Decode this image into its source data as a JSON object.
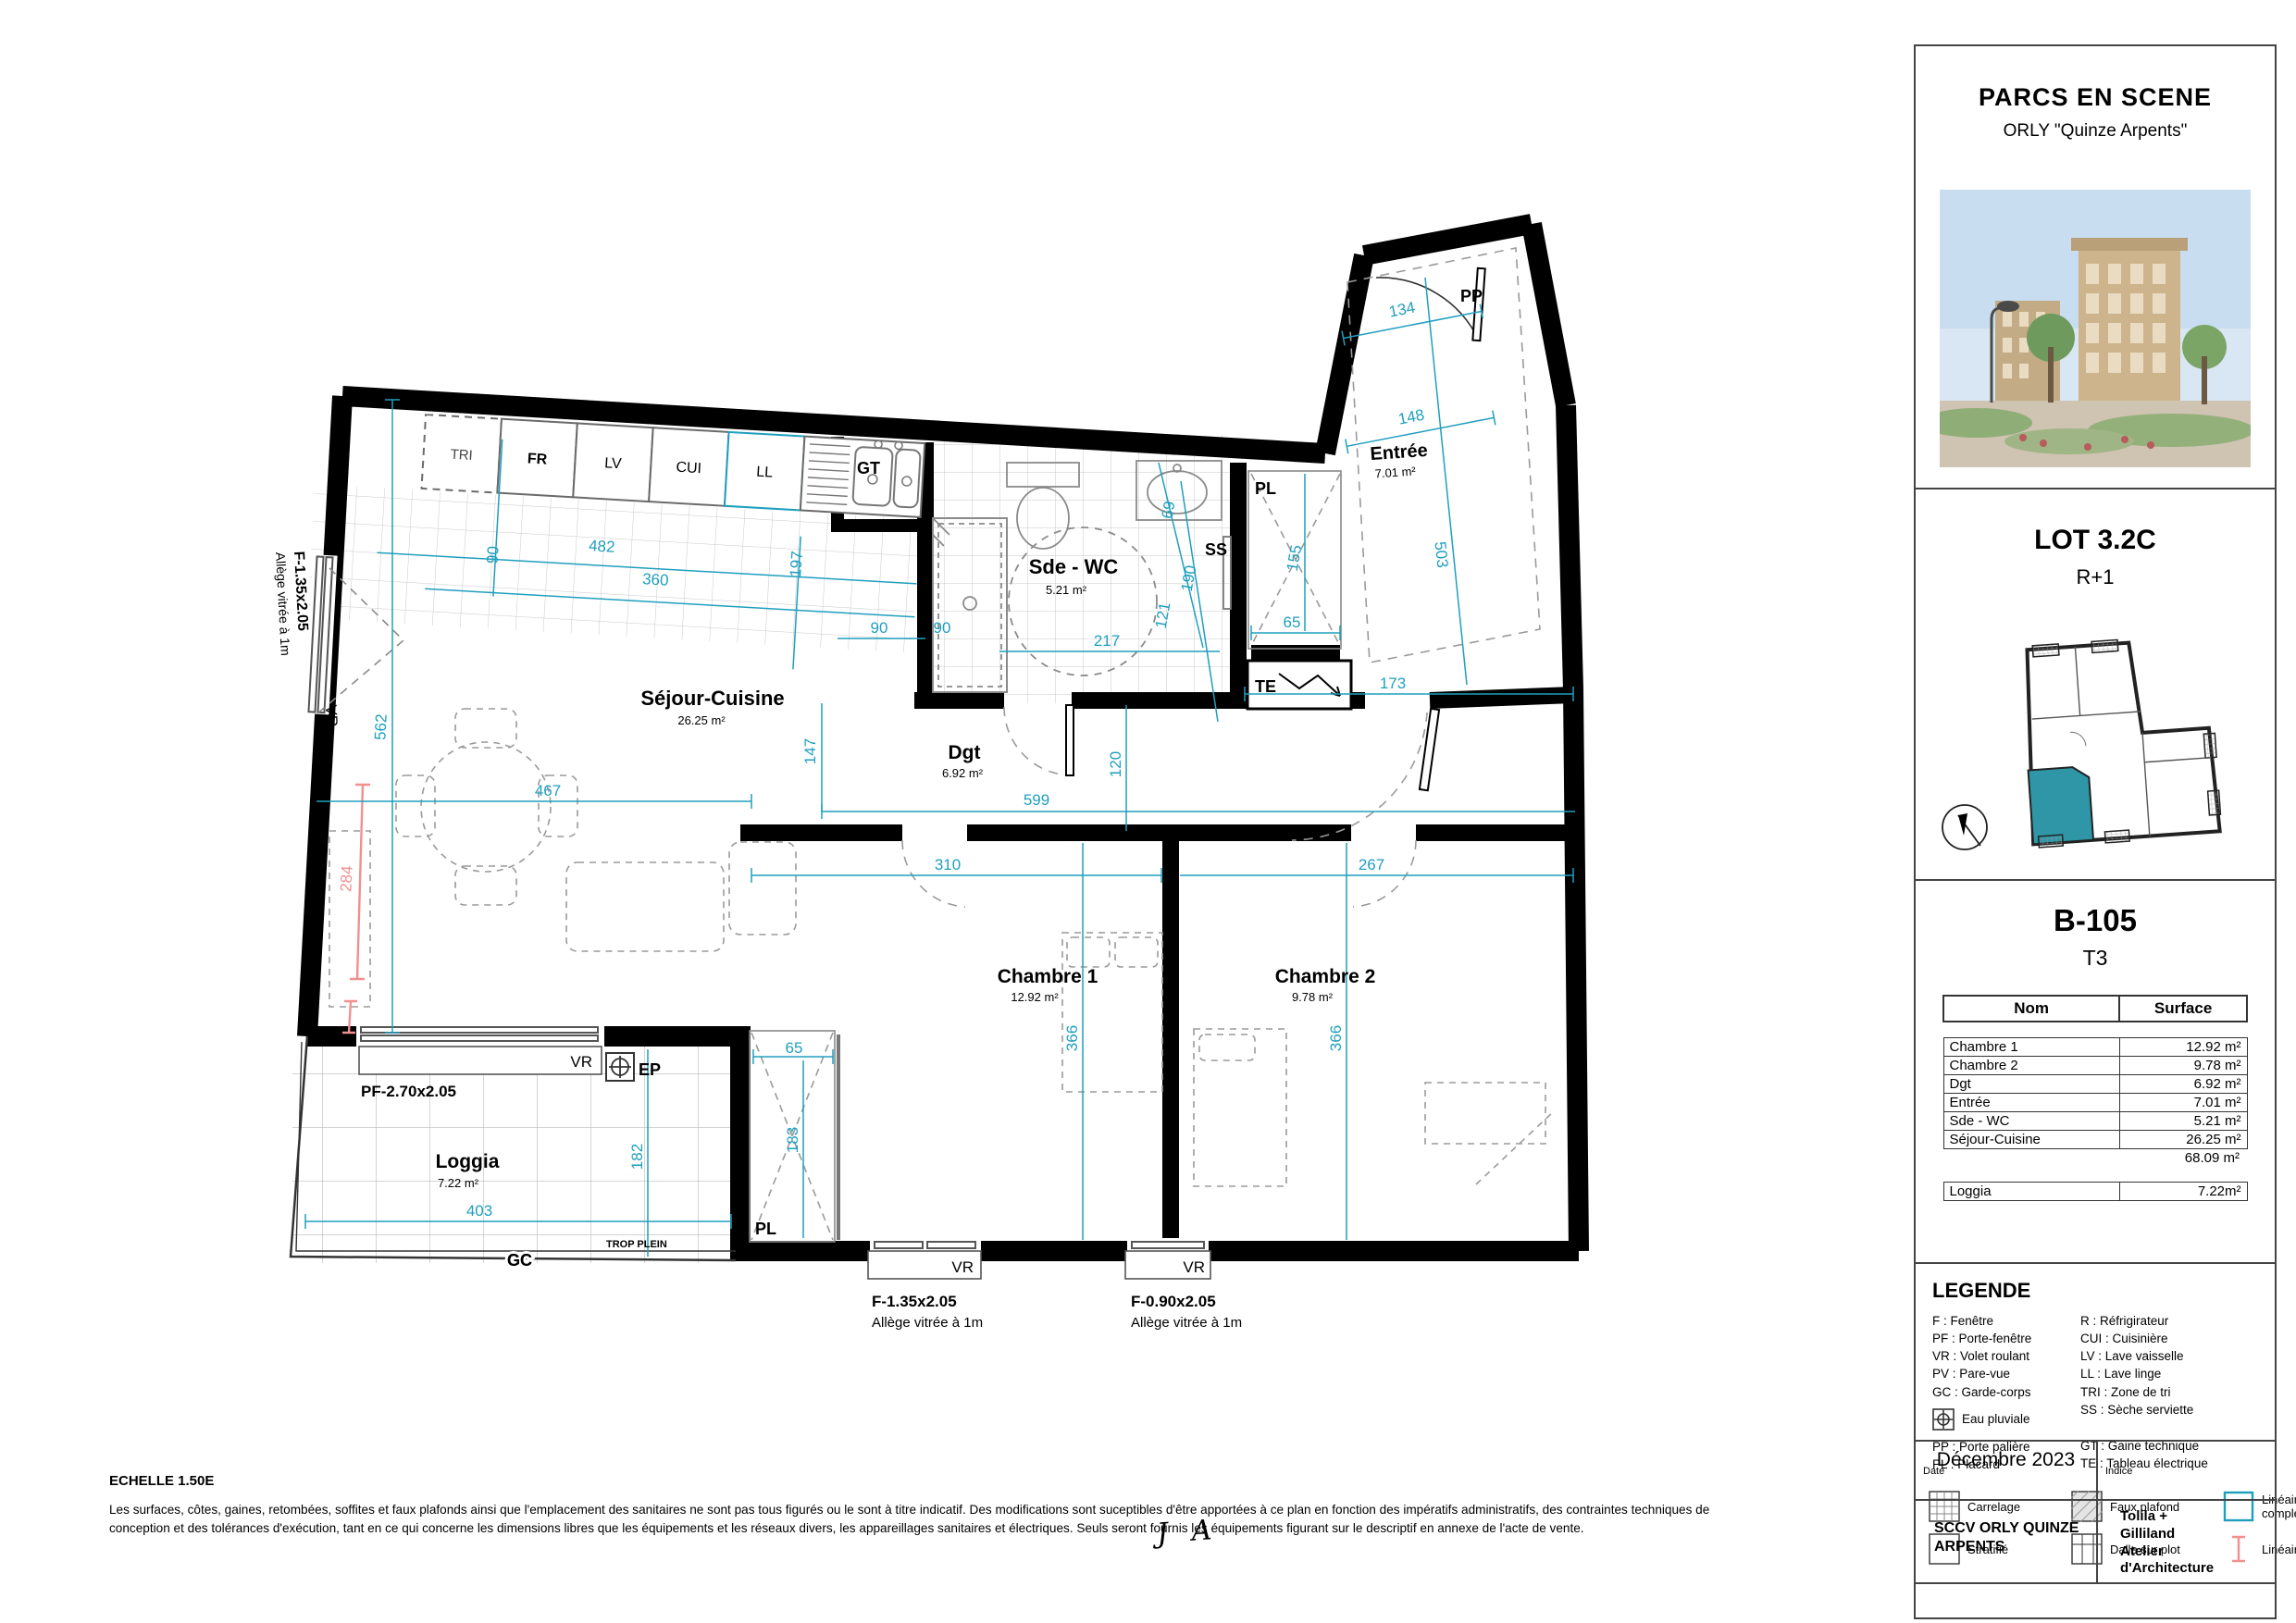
{
  "plan": {
    "rooms": {
      "entree": {
        "name": "Entrée",
        "area": "7.01 m²"
      },
      "sde": {
        "name": "Sde - WC",
        "area": "5.21 m²"
      },
      "sejour": {
        "name": "Séjour-Cuisine",
        "area": "26.25 m²"
      },
      "dgt": {
        "name": "Dgt",
        "area": "6.92 m²"
      },
      "ch1": {
        "name": "Chambre 1",
        "area": "12.92 m²"
      },
      "ch2": {
        "name": "Chambre 2",
        "area": "9.78 m²"
      },
      "loggia": {
        "name": "Loggia",
        "area": "7.22 m²"
      }
    },
    "dims": [
      "134",
      "148",
      "503",
      "173",
      "120",
      "599",
      "147",
      "90",
      "482",
      "360",
      "197",
      "90",
      "69",
      "190",
      "121",
      "217",
      "90",
      "65",
      "155",
      "310",
      "267",
      "366",
      "366",
      "65",
      "183",
      "182",
      "403",
      "562",
      "467",
      "284"
    ],
    "tags": {
      "pp": "PP",
      "gt": "GT",
      "ss": "SS",
      "pl": "PL",
      "te": "TE",
      "vr": "VR",
      "ep": "EP",
      "gc": "GC",
      "trop": "TROP PLEIN",
      "pf": "PF-2.70x2.05",
      "f135": "F-1.35x2.05",
      "f090": "F-0.90x2.05",
      "allege": "Allège vitrée à 1m"
    },
    "appliances": [
      "TRI",
      "FR",
      "LV",
      "CUI",
      "LL"
    ],
    "colors": {
      "dim": "#1f9fbe",
      "red": "#f28f8f",
      "unit_fill": "#2e96a6"
    }
  },
  "panel": {
    "project_title": "PARCS EN SCENE",
    "project_subtitle": "ORLY \"Quinze Arpents\"",
    "lot_title": "LOT 3.2C",
    "lot_level": "R+1",
    "unit_id": "B-105",
    "unit_type": "T3",
    "table": {
      "headers": [
        "Nom",
        "Surface"
      ],
      "rows": [
        [
          "Chambre 1",
          "12.92 m²"
        ],
        [
          "Chambre 2",
          "9.78 m²"
        ],
        [
          "Dgt",
          "6.92 m²"
        ],
        [
          "Entrée",
          "7.01 m²"
        ],
        [
          "Sde - WC",
          "5.21 m²"
        ],
        [
          "Séjour-Cuisine",
          "26.25 m²"
        ]
      ],
      "total": "68.09 m²",
      "loggia_row": [
        "Loggia",
        "7.22m²"
      ]
    },
    "legend": {
      "title": "LEGENDE",
      "col1": [
        "F : Fenêtre",
        "PF : Porte-fenêtre",
        "VR : Volet roulant",
        "PV : Pare-vue",
        "GC : Garde-corps"
      ],
      "eau_pluviale": "Eau pluviale",
      "col1b": [
        "PP : Porte palière",
        "PL : Placard"
      ],
      "col2": [
        "R : Réfrigirateur",
        "CUI : Cuisinière",
        "LV : Lave vaisselle",
        "LL : Lave linge",
        "TRI : Zone de tri",
        "SS : Sèche serviette"
      ],
      "col2b": [
        "GT : Gaine technique",
        "TE : Tableau électrique"
      ],
      "swatches": [
        "Carrelage",
        "Faux plafond",
        "Linéaire complémentaire",
        "Stratifié",
        "Dalle sur plot",
        "Linéaire mur libre"
      ]
    },
    "titleblock": {
      "date_label": "Date",
      "date": "Décembre 2023",
      "indice_label": "Indice",
      "client": "SCCV ORLY QUINZE ARPENTS",
      "architect_l1": "Tolila +",
      "architect_l2": "Gilliland",
      "architect_l3": "Atelier",
      "architect_l4": "d'Architecture"
    }
  },
  "footer": {
    "scale": "ECHELLE 1.50E",
    "disclaimer": "Les surfaces, côtes, gaines, retombées, soffites et faux plafonds ainsi que l'emplacement des sanitaires ne sont pas tous figurés ou le sont à titre indicatif. Des modifications sont suceptibles d'être apportées à ce plan en fonction des impératifs administratifs, des contraintes techniques de conception et des tolérances d'exécution, tant en ce qui concerne les dimensions libres que les équipements et les réseaux divers, les appareillages sanitaires et électriques. Seuls seront fournis les équipements figurant sur le descriptif en annexe de l'acte de vente.",
    "initials": "J A"
  }
}
